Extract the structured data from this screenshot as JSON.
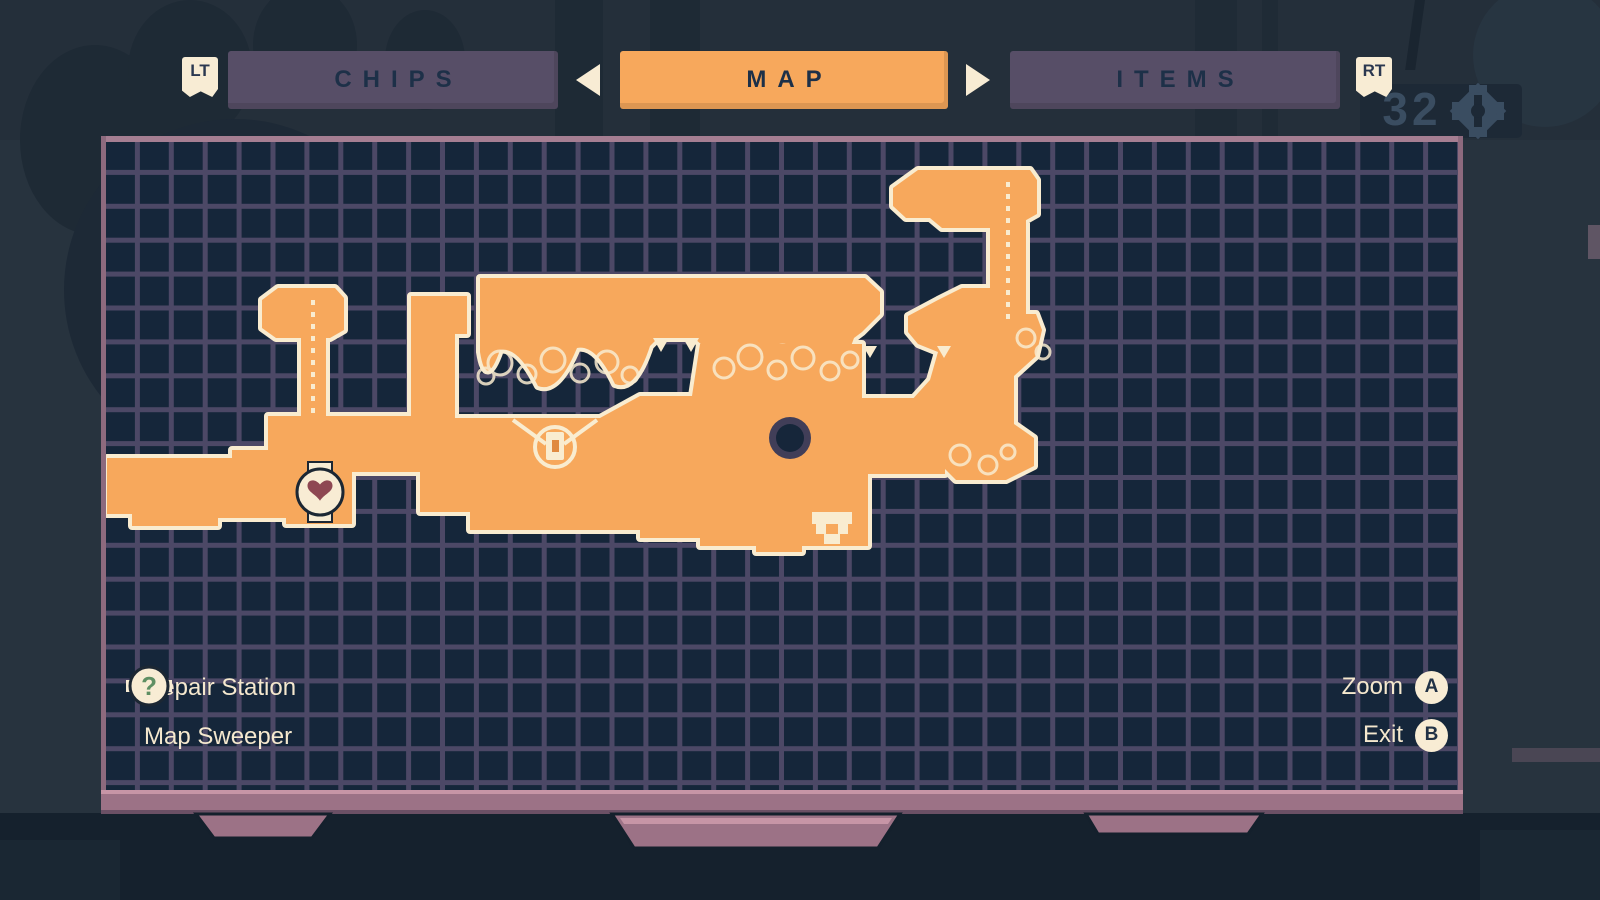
{
  "screen_title": "MAP",
  "tabs": {
    "left_bumper_label": "LT",
    "right_bumper_label": "RT",
    "items": [
      {
        "label": "CHIPS",
        "active": false
      },
      {
        "label": "MAP",
        "active": true
      },
      {
        "label": "ITEMS",
        "active": false
      }
    ]
  },
  "map_panel": {
    "legend": [
      {
        "icon": "repair-station",
        "label": "Repair Station"
      },
      {
        "icon": "map-sweeper",
        "label": "Map Sweeper",
        "glyph": "?"
      }
    ],
    "controls": [
      {
        "label": "Zoom",
        "button": "A"
      },
      {
        "label": "Exit",
        "button": "B"
      }
    ],
    "markers": [
      "repair-station-marker",
      "train-station-marker",
      "gate-marker",
      "player-position-marker"
    ]
  },
  "hud": {
    "gear_count": "32"
  },
  "colors": {
    "explored_area": "#f7a85c",
    "area_outline": "#f9ecd0",
    "map_background": "#15263a",
    "grid_line": "#4c4866",
    "panel_frame": "#9c7286",
    "tab_active": "#f7a85c",
    "tab_inactive": "#574e67",
    "tab_text": "#1d3048",
    "legend_text": "#f5e8ce",
    "heart": "#8e4752",
    "question_mark": "#5f8f63"
  }
}
